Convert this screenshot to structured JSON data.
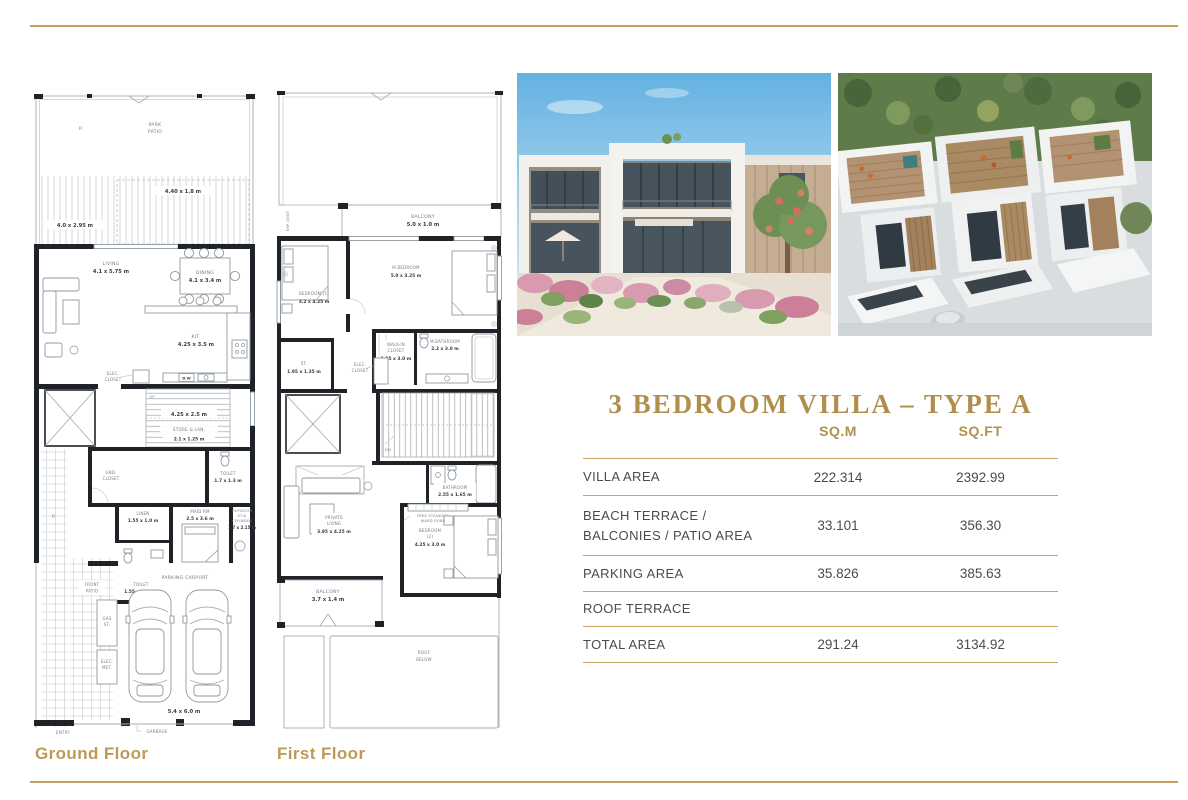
{
  "page": {
    "title": "3 BEDROOM VILLA – TYPE A"
  },
  "colors": {
    "gold_title": "#B18E4C",
    "gold_line": "#C8A35F",
    "gold_caption": "#BD9A57",
    "table_text": "#4B4B4B"
  },
  "photos": {
    "street": "street-view-villa-render",
    "aerial": "aerial-rooftop-terraces-render"
  },
  "ground": {
    "caption": "Ground Floor",
    "labels": {
      "p_top": "P.",
      "park_1": "PARK",
      "park_2": "PATIO",
      "deck_dim": "4.40 x 1.8 m",
      "deck_dim2": "4.0 x 2.95 m",
      "living_1": "LIVING",
      "living_2": "4.1 x 5.75 m",
      "dining_1": "DINING",
      "dining_2": "4.1 x 3.4 m",
      "kit_1": "KIT.",
      "kit_2": "4.25 x 3.5 m",
      "dw": "D.W",
      "elec_1": "ELEC.",
      "elec_2": "CLOSET",
      "up": "UP",
      "stair_dim": "4.25 x 2.5 m",
      "store_1": "STORE & LAN.",
      "store_2": "2.1 x 1.25 m",
      "gnd_1": "GND.",
      "gnd_2": "CLOSET",
      "toilet1_1": "TOILET",
      "toilet1_2": "1.7 x 1.3 m",
      "linen_1": "LINEN",
      "linen_2": "1.55 x 1.0 m",
      "maid_1": "MAID RM",
      "maid_2": "2.5 x 3.6 m",
      "out_1": "OUTDOOR",
      "out_2": "ST.&",
      "out_3": "CYLINDER",
      "out_4": "1.7 x 2.15 m",
      "toilet2_1": "TOILET",
      "toilet2_2": "1.55 x 1.65 m",
      "p_left": "P.",
      "front_1": "FRONT",
      "front_2": "PATIO",
      "parking": "PARKING CARPORT",
      "car_dim": "5.4 x 6.0 m",
      "gas_1": "GAS",
      "gas_2": "ST.",
      "em_1": "ELEC.",
      "em_2": "MET.",
      "entry": "ENTRY",
      "garbage": "GARBAGE"
    }
  },
  "first": {
    "caption": "First Floor",
    "labels": {
      "exp": "EXP. JOINT",
      "bal1_1": "BALCONY",
      "bal1_2": "5.0 x 1.0 m",
      "mbed_1": "M.BEDROOM",
      "mbed_2": "5.0 x 3.25 m",
      "bed1_1": "BEDROOM  (1)",
      "bed1_2": "3.2 x 4.25 m",
      "wic_1": "WALK-IN",
      "wic_2": "CLOSET",
      "wic_3": "1.35 x 3.0 m",
      "mbath_1": "M.BATHROOM",
      "mbath_2": "2.2 x 3.0 m",
      "st_1": "ST.",
      "st_2": "1.95 x 1.35 m",
      "elec_1": "ELEC.",
      "elec_2": "CLOSET",
      "dn": "DN",
      "sky": "SKYLIGHT",
      "bath_1": "BATHROOM",
      "bath_2": "2.55 x 1.65 m",
      "pl_1": "PRIVATE",
      "pl_2": "LIVING",
      "pl_3": "3.95 x 4.25 m",
      "ward_1": "FREE STANDING",
      "ward_2": "WARD ROBE",
      "bed2_1": "BEDROOM",
      "bed2_2": "(2)",
      "bed2_3": "4.25 x 3.0 m",
      "bal2_1": "BALCONY",
      "bal2_2": "3.7 x 1.4 m",
      "roof_1": "ROOF",
      "roof_2": "BELOW"
    }
  },
  "table": {
    "col_sqm": "SQ.M",
    "col_sqft": "SQ.FT",
    "rows": [
      {
        "label": "VILLA AREA",
        "label2": "",
        "sqm": "222.314",
        "sqft": "2392.99"
      },
      {
        "label": "BEACH TERRACE /",
        "label2": "BALCONIES / PATIO AREA",
        "sqm": "33.101",
        "sqft": "356.30"
      },
      {
        "label": "PARKING AREA",
        "label2": "",
        "sqm": "35.826",
        "sqft": "385.63"
      },
      {
        "label": "ROOF TERRACE",
        "label2": "",
        "sqm": "",
        "sqft": ""
      },
      {
        "label": "TOTAL AREA",
        "label2": "",
        "sqm": "291.24",
        "sqft": "3134.92"
      }
    ]
  }
}
